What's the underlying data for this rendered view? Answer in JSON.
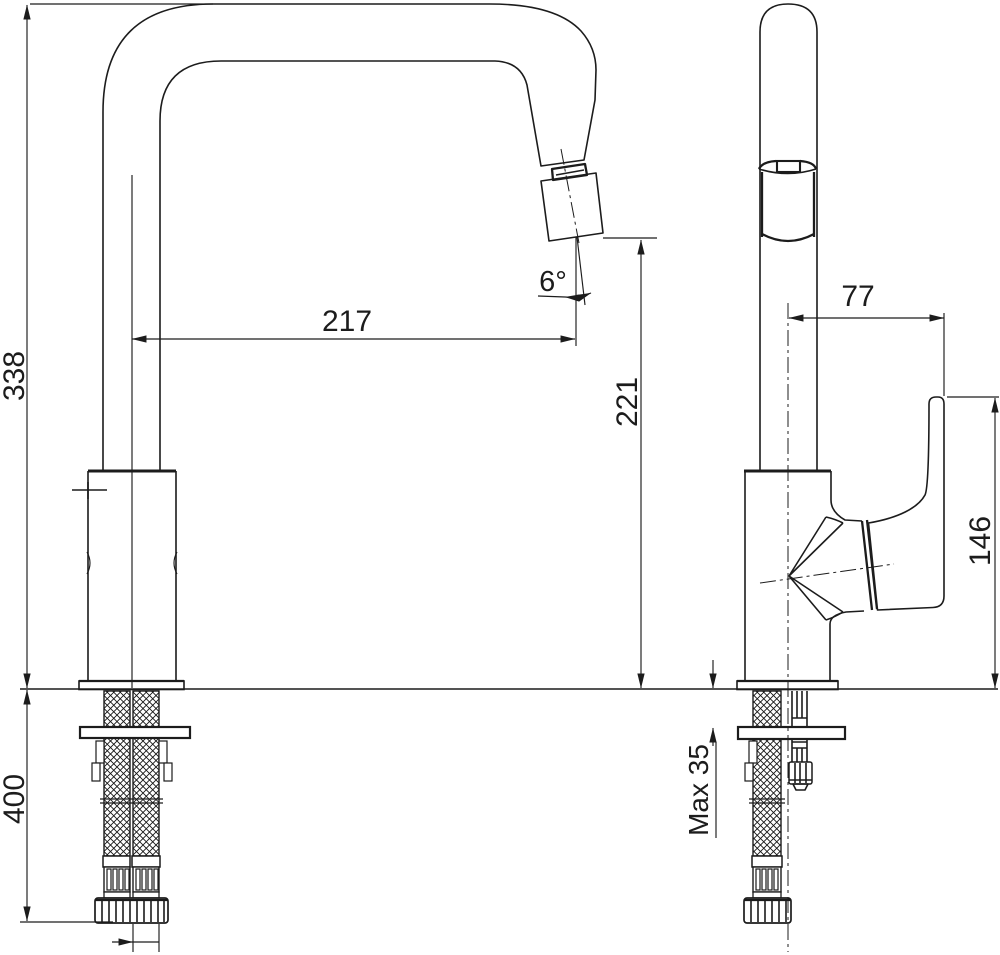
{
  "drawing": {
    "type": "technical-dimension-drawing",
    "subject": "kitchen sink mixer tap, front and side elevation",
    "background_color": "#ffffff",
    "line_color": "#1c1c1c",
    "dimensions": {
      "spout_height": "338",
      "hose_length": "400",
      "spout_reach": "217",
      "outlet_height": "221",
      "outlet_angle": "6°",
      "handle_offset": "77",
      "handle_height": "146",
      "max_counter_thickness": "Max 35"
    }
  }
}
